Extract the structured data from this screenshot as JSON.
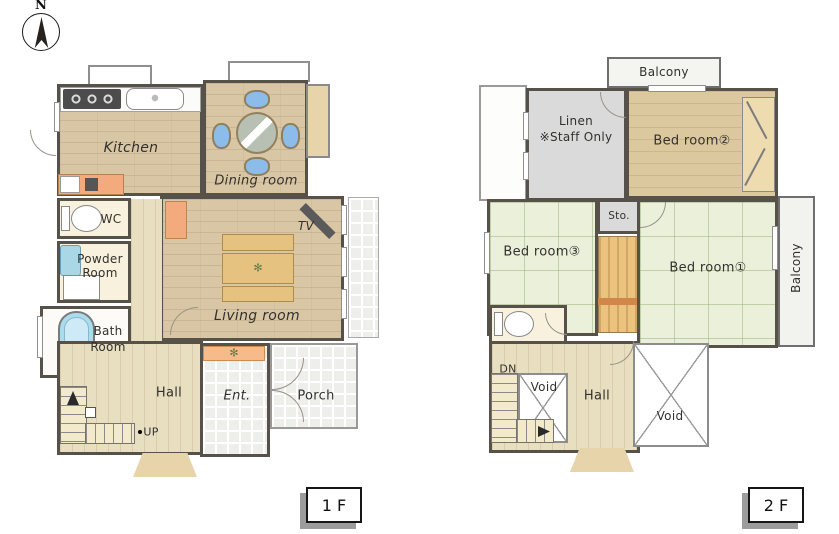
{
  "compass": {
    "north": "N"
  },
  "decor": {
    "flower": "✻"
  },
  "floor1": {
    "badge": "1 F",
    "kitchen": "Kitchen",
    "dining_room": "Dining room",
    "wc": "WC",
    "powder_line1": "Powder",
    "powder_line2": "Room",
    "bath_line1": "Bath",
    "bath_line2": "Room",
    "living_room": "Living room",
    "tv": "TV",
    "hall": "Hall",
    "up": "UP",
    "entrance": "Ent.",
    "porch": "Porch"
  },
  "floor2": {
    "badge": "2 F",
    "balcony_top": "Balcony",
    "linen_line1": "Linen",
    "linen_line2": "※Staff Only",
    "bedroom2": "Bed room②",
    "storage": "Sto.",
    "bedroom3": "Bed room③",
    "bedroom1": "Bed room①",
    "balcony_right": "Balcony",
    "down": "DN",
    "void_left": "Void",
    "void_right": "Void",
    "hall": "Hall"
  },
  "colors": {
    "wall": "#56524a",
    "wood_floor": "#d8c6a4",
    "hall_floor": "#e8dec0",
    "tatami_floor": "#ebf0da",
    "linen_gray": "#dadada",
    "tile": "#eeeeea",
    "stairs": "#f3e9cb",
    "accent_orange": "#f3ab7d",
    "water_blue": "#abdcee",
    "chair_blue": "#8cbce9",
    "bay_tan": "#e7d4aa"
  }
}
